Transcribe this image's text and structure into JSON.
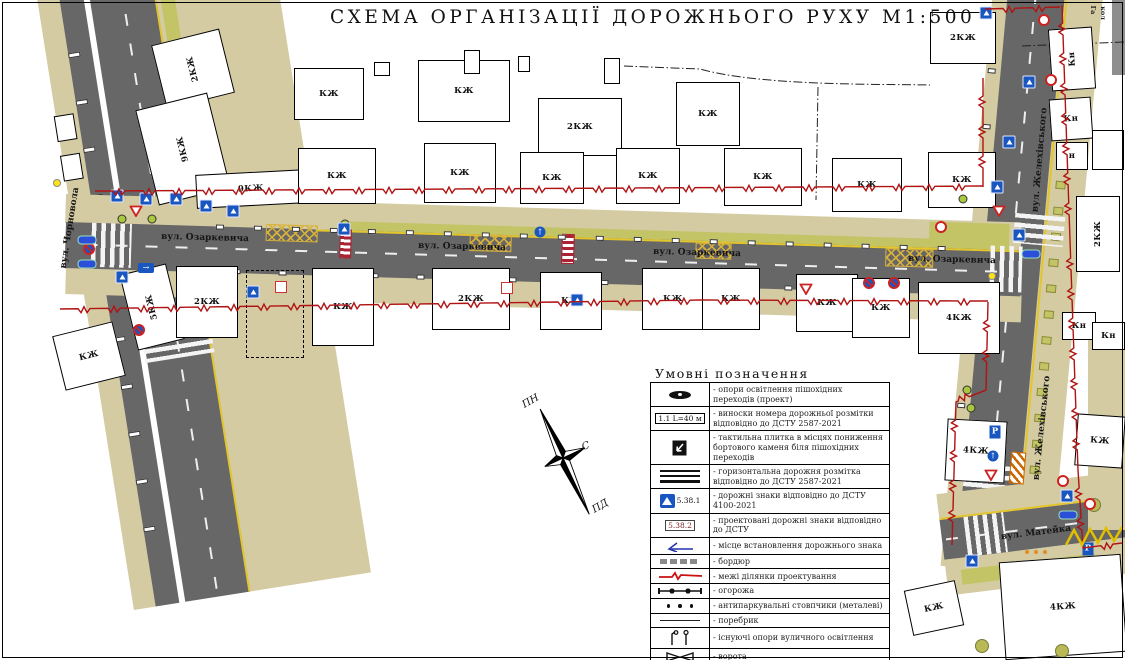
{
  "title": "СХЕМА ОРГАНІЗАЦІЇ ДОРОЖНЬОГО РУХУ М1:500",
  "compass": {
    "north": "ПН",
    "east": "С",
    "south": "ПД"
  },
  "colors": {
    "road": "#676767",
    "sidewalk": "#d4cba2",
    "greenery": "#c3c465",
    "boundary_red": "#b11212",
    "marking_yellow": "#e3c52e",
    "sign_blue": "#1a56c0",
    "projected_red": "#c22222"
  },
  "streets": [
    {
      "name": "вул. Чорновола",
      "x": 70,
      "y": 228,
      "rot": -81
    },
    {
      "name": "вул. Озаркевича",
      "x": 205,
      "y": 238,
      "rot": 1.5
    },
    {
      "name": "вул. Озаркевича",
      "x": 462,
      "y": 247,
      "rot": 1.5
    },
    {
      "name": "вул. Озаркевича",
      "x": 697,
      "y": 253,
      "rot": 1.5
    },
    {
      "name": "вул. Озаркевича",
      "x": 952,
      "y": 260,
      "rot": 1.5
    },
    {
      "name": "вул. Желехівського",
      "x": 1040,
      "y": 160,
      "rot": -85
    },
    {
      "name": "вул. Желехівського",
      "x": 1042,
      "y": 428,
      "rot": -84
    },
    {
      "name": "вул. Матейка",
      "x": 1036,
      "y": 533,
      "rot": -7
    }
  ],
  "misc_labels": [
    {
      "text": "Га",
      "x": 1093,
      "y": 10,
      "rot": 90
    },
    {
      "text": "кол",
      "x": 1103,
      "y": 13,
      "rot": 90
    }
  ],
  "buildings": [
    {
      "label": "2КЖ",
      "x": 158,
      "y": 36,
      "w": 70,
      "h": 66,
      "rot": -14,
      "vert": true
    },
    {
      "label": "9КЖ",
      "x": 146,
      "y": 100,
      "w": 74,
      "h": 98,
      "rot": -14,
      "vert": true
    },
    {
      "label": "9КЖ",
      "x": 196,
      "y": 172,
      "w": 110,
      "h": 34,
      "rot": -3
    },
    {
      "label": "КЖ",
      "x": 294,
      "y": 68,
      "w": 70,
      "h": 52,
      "rot": 0
    },
    {
      "label": "КЖ",
      "x": 298,
      "y": 148,
      "w": 78,
      "h": 56,
      "rot": 0
    },
    {
      "label": "КЖ",
      "x": 418,
      "y": 60,
      "w": 92,
      "h": 62,
      "rot": 0
    },
    {
      "label": "КЖ",
      "x": 424,
      "y": 143,
      "w": 72,
      "h": 60,
      "rot": 0
    },
    {
      "label": "2КЖ",
      "x": 538,
      "y": 98,
      "w": 84,
      "h": 58,
      "rot": 0
    },
    {
      "label": "КЖ",
      "x": 520,
      "y": 152,
      "w": 64,
      "h": 52,
      "rot": 0
    },
    {
      "label": "КЖ",
      "x": 616,
      "y": 148,
      "w": 64,
      "h": 56,
      "rot": 0
    },
    {
      "label": "КЖ",
      "x": 676,
      "y": 82,
      "w": 64,
      "h": 64,
      "rot": 0
    },
    {
      "label": "КЖ",
      "x": 724,
      "y": 148,
      "w": 78,
      "h": 58,
      "rot": 0
    },
    {
      "label": "КЖ",
      "x": 832,
      "y": 158,
      "w": 70,
      "h": 54,
      "rot": 0
    },
    {
      "label": "КЖ",
      "x": 928,
      "y": 152,
      "w": 68,
      "h": 56,
      "rot": 0
    },
    {
      "label": "2КЖ",
      "x": 930,
      "y": 12,
      "w": 66,
      "h": 52,
      "rot": 0
    },
    {
      "label": "2КЖ",
      "x": 1076,
      "y": 196,
      "w": 44,
      "h": 76,
      "rot": 0,
      "vert": true
    },
    {
      "label": "Кн",
      "x": 1050,
      "y": 28,
      "w": 44,
      "h": 62,
      "rot": -4,
      "vert": true
    },
    {
      "label": "Кн",
      "x": 1050,
      "y": 98,
      "w": 42,
      "h": 42,
      "rot": -4
    },
    {
      "label": "н",
      "x": 1056,
      "y": 142,
      "w": 32,
      "h": 28,
      "rot": 0
    },
    {
      "label": "",
      "x": 1092,
      "y": 130,
      "w": 32,
      "h": 40,
      "rot": 0
    },
    {
      "label": "Кн",
      "x": 1062,
      "y": 312,
      "w": 34,
      "h": 28,
      "rot": 0
    },
    {
      "label": "Кн",
      "x": 1092,
      "y": 322,
      "w": 33,
      "h": 28,
      "rot": 0
    },
    {
      "label": "КЖ",
      "x": 58,
      "y": 328,
      "w": 62,
      "h": 56,
      "rot": -14
    },
    {
      "label": "5КЖ",
      "x": 128,
      "y": 268,
      "w": 48,
      "h": 78,
      "rot": -14,
      "vert": true
    },
    {
      "label": "2КЖ",
      "x": 176,
      "y": 266,
      "w": 62,
      "h": 72,
      "rot": 0
    },
    {
      "label": "",
      "x": 246,
      "y": 270,
      "w": 58,
      "h": 88,
      "rot": 0,
      "dashed": true
    },
    {
      "label": "КЖ",
      "x": 312,
      "y": 268,
      "w": 62,
      "h": 78,
      "rot": 0
    },
    {
      "label": "2КЖ",
      "x": 432,
      "y": 268,
      "w": 78,
      "h": 62,
      "rot": 0
    },
    {
      "label": "КЖ",
      "x": 540,
      "y": 272,
      "w": 62,
      "h": 58,
      "rot": 0
    },
    {
      "label": "КЖ",
      "x": 642,
      "y": 268,
      "w": 62,
      "h": 62,
      "rot": 0
    },
    {
      "label": "КЖ",
      "x": 702,
      "y": 268,
      "w": 58,
      "h": 62,
      "rot": 0
    },
    {
      "label": "КЖ",
      "x": 796,
      "y": 274,
      "w": 62,
      "h": 58,
      "rot": 0
    },
    {
      "label": "КЖ",
      "x": 852,
      "y": 278,
      "w": 58,
      "h": 60,
      "rot": 0
    },
    {
      "label": "4КЖ",
      "x": 918,
      "y": 282,
      "w": 82,
      "h": 72,
      "rot": 0
    },
    {
      "label": "4КЖ",
      "x": 946,
      "y": 420,
      "w": 60,
      "h": 62,
      "rot": 3
    },
    {
      "label": "КЖ",
      "x": 1076,
      "y": 415,
      "w": 48,
      "h": 52,
      "rot": 4
    },
    {
      "label": "4КЖ",
      "x": 1002,
      "y": 558,
      "w": 122,
      "h": 98,
      "rot": -4
    },
    {
      "label": "КЖ",
      "x": 908,
      "y": 585,
      "w": 52,
      "h": 46,
      "rot": -12
    },
    {
      "label": "",
      "x": 374,
      "y": 62,
      "w": 16,
      "h": 14,
      "rot": 0
    },
    {
      "label": "",
      "x": 464,
      "y": 50,
      "w": 16,
      "h": 24,
      "rot": 0
    },
    {
      "label": "",
      "x": 518,
      "y": 56,
      "w": 12,
      "h": 16,
      "rot": 0
    },
    {
      "label": "",
      "x": 604,
      "y": 58,
      "w": 16,
      "h": 26,
      "rot": 0
    }
  ],
  "signs": [
    {
      "kind": "pb",
      "x": 117,
      "y": 196
    },
    {
      "kind": "pb",
      "x": 146,
      "y": 199
    },
    {
      "kind": "pb",
      "x": 176,
      "y": 199
    },
    {
      "kind": "gw",
      "x": 136,
      "y": 211
    },
    {
      "kind": "pb",
      "x": 206,
      "y": 206
    },
    {
      "kind": "pb",
      "x": 233,
      "y": 211
    },
    {
      "kind": "arr",
      "x": 146,
      "y": 268
    },
    {
      "kind": "pb",
      "x": 122,
      "y": 277
    },
    {
      "kind": "pb",
      "x": 253,
      "y": 292
    },
    {
      "kind": "proj",
      "x": 281,
      "y": 287
    },
    {
      "kind": "nostop",
      "x": 89,
      "y": 249
    },
    {
      "kind": "nostop",
      "x": 139,
      "y": 330
    },
    {
      "kind": "pb",
      "x": 344,
      "y": 229
    },
    {
      "kind": "pbc",
      "x": 540,
      "y": 232
    },
    {
      "kind": "pb",
      "x": 577,
      "y": 300
    },
    {
      "kind": "proj",
      "x": 507,
      "y": 288
    },
    {
      "kind": "gw",
      "x": 806,
      "y": 289
    },
    {
      "kind": "nostop",
      "x": 869,
      "y": 283
    },
    {
      "kind": "nostop",
      "x": 894,
      "y": 283
    },
    {
      "kind": "prohib",
      "x": 941,
      "y": 227
    },
    {
      "kind": "gw",
      "x": 999,
      "y": 211
    },
    {
      "kind": "pb",
      "x": 997,
      "y": 187
    },
    {
      "kind": "pb",
      "x": 1019,
      "y": 235
    },
    {
      "kind": "pb",
      "x": 986,
      "y": 13
    },
    {
      "kind": "prohib",
      "x": 1044,
      "y": 20
    },
    {
      "kind": "pb",
      "x": 1029,
      "y": 82
    },
    {
      "kind": "prohib",
      "x": 1051,
      "y": 80
    },
    {
      "kind": "pb",
      "x": 1009,
      "y": 142
    },
    {
      "kind": "P",
      "x": 995,
      "y": 432
    },
    {
      "kind": "pbc",
      "x": 993,
      "y": 456
    },
    {
      "kind": "gw",
      "x": 991,
      "y": 475
    },
    {
      "kind": "prohib",
      "x": 1063,
      "y": 481
    },
    {
      "kind": "pb",
      "x": 1067,
      "y": 496
    },
    {
      "kind": "prohib",
      "x": 1090,
      "y": 504
    },
    {
      "kind": "P",
      "x": 1088,
      "y": 549
    },
    {
      "kind": "pb",
      "x": 972,
      "y": 561
    },
    {
      "kind": "pill",
      "x": 1031,
      "y": 254
    },
    {
      "kind": "pill",
      "x": 1068,
      "y": 515
    },
    {
      "kind": "pill",
      "x": 87,
      "y": 240
    },
    {
      "kind": "pill",
      "x": 87,
      "y": 264
    }
  ],
  "trees": [
    {
      "x": 122,
      "y": 219
    },
    {
      "x": 152,
      "y": 219
    },
    {
      "x": 345,
      "y": 224
    },
    {
      "x": 963,
      "y": 199
    },
    {
      "x": 967,
      "y": 390
    },
    {
      "x": 971,
      "y": 408
    },
    {
      "x": 1094,
      "y": 505,
      "big": true
    },
    {
      "x": 982,
      "y": 646,
      "big": true
    },
    {
      "x": 1062,
      "y": 651,
      "big": true
    }
  ],
  "ydots": [
    {
      "x": 57,
      "y": 183
    },
    {
      "x": 992,
      "y": 276
    }
  ],
  "bollards": [
    {
      "x": 1027,
      "y": 552
    },
    {
      "x": 1036,
      "y": 552
    },
    {
      "x": 1045,
      "y": 552
    }
  ],
  "legend": {
    "title": "Умовні позначення",
    "rows": [
      {
        "icon": "light-pole",
        "text": "- опори освітлення пішохідних переходів (проект)"
      },
      {
        "icon": "marking-callout",
        "icon_text": "1.1 L=40 м",
        "text": "- виноски номера дорожньої розмітки відповідно до ДСТУ 2587-2021"
      },
      {
        "icon": "tactile-tile",
        "text": "- тактильна плитка в місцях пониження бортового каменя біля пішохідних переходів"
      },
      {
        "icon": "road-marking",
        "text": "- горизонтальна дорожня розмітка відповідно до ДСТУ 2587-2021"
      },
      {
        "icon": "road-sign",
        "icon_text": "5.38.1",
        "text": "- дорожні знаки відповідно до ДСТУ 4100-2021"
      },
      {
        "icon": "projected-sign",
        "icon_text": "5.38.2",
        "text": "- проектовані дорожні знаки відповідно до ДСТУ"
      },
      {
        "icon": "sign-location",
        "text": "- місце встановлення дорожнього знака"
      },
      {
        "icon": "curb",
        "text": "- бордюр"
      },
      {
        "icon": "project-boundary",
        "text": "- межі ділянки проектування"
      },
      {
        "icon": "fence",
        "text": "- огорожа"
      },
      {
        "icon": "metal-bollards",
        "text": "- антипаркувальні стовпчики (металеві)"
      },
      {
        "icon": "edge-curb",
        "text": "- поребрик"
      },
      {
        "icon": "street-lights",
        "text": "- існуючі опори вуличного освітлення"
      },
      {
        "icon": "gate",
        "text": "- ворота"
      },
      {
        "icon": "plastic-bollards",
        "text": "- антипаркувальні стовпчики (пластикові)"
      }
    ]
  }
}
